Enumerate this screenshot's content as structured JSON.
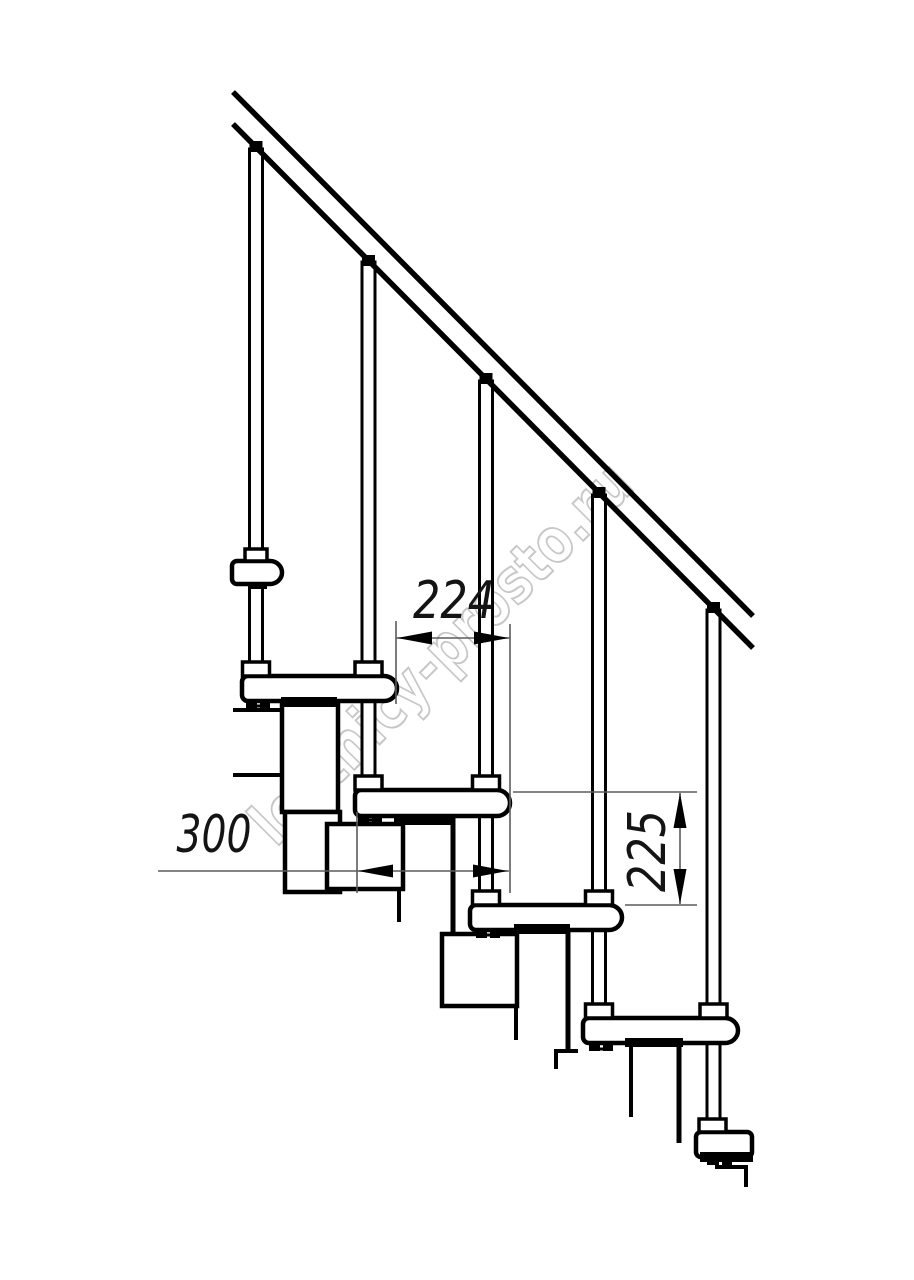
{
  "page": {
    "background": "#ffffff"
  },
  "drawing": {
    "type": "modular staircase side-view technical drawing",
    "watermark": {
      "text": "lestnicy-prosto.ru",
      "color": "#c7c7c7"
    },
    "colors": {
      "line": "#000000",
      "dimension": "#5c5c5c",
      "background": "#ffffff"
    },
    "dimensions": {
      "going": "224",
      "tread_depth": "300",
      "riser_height": "225"
    }
  }
}
